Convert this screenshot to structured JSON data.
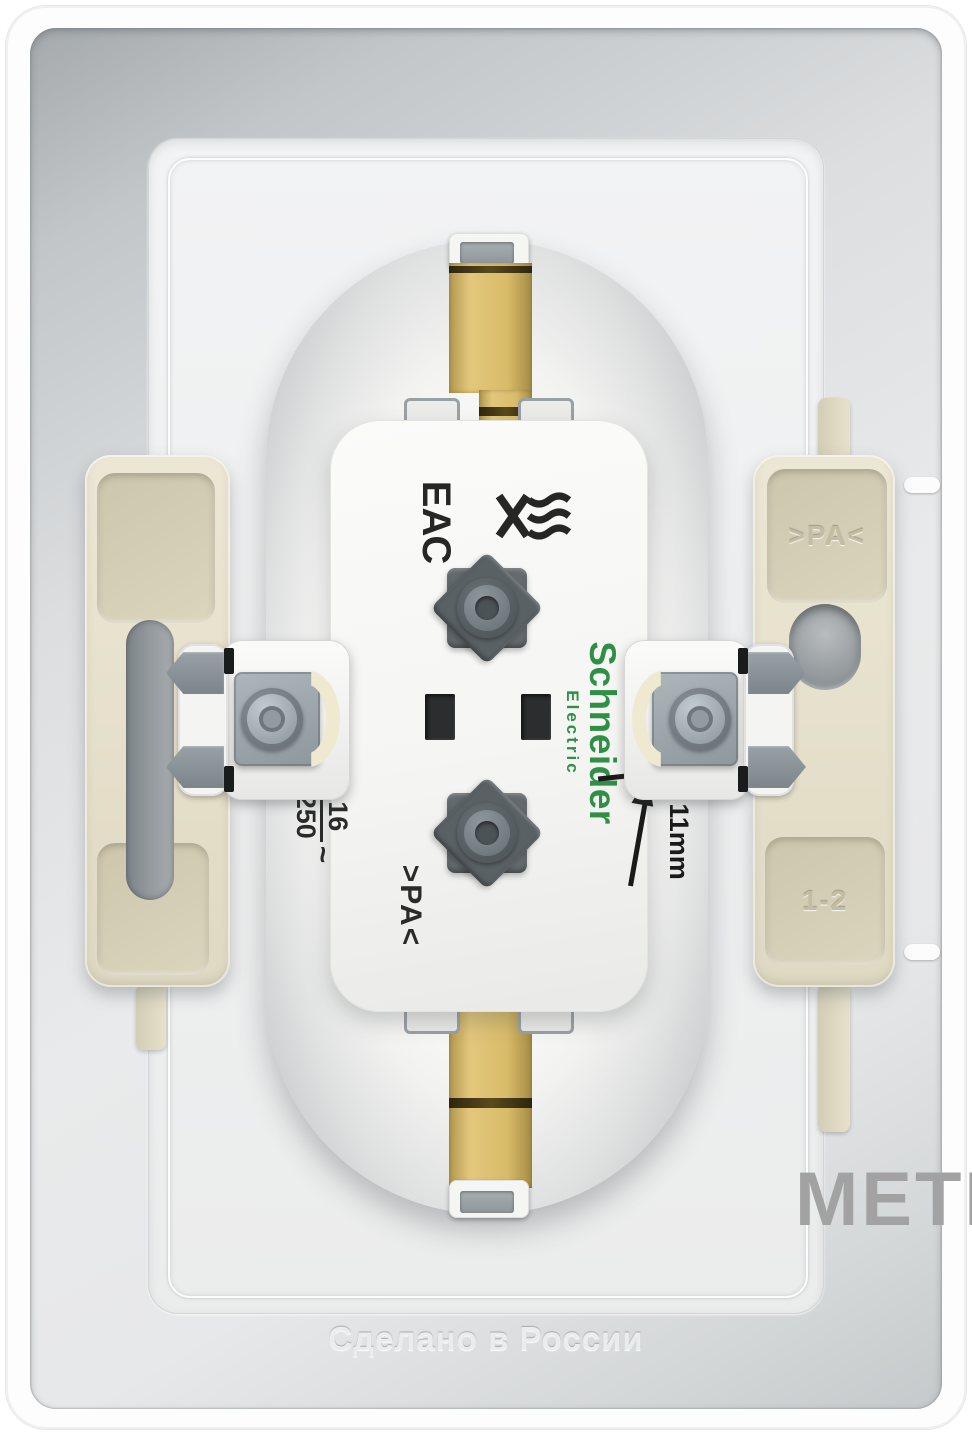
{
  "branding": {
    "name": "Schneider",
    "sub": "Electric"
  },
  "certs": {
    "eac": "ЕАС"
  },
  "ratings": {
    "current": "16",
    "voltage": "250",
    "ac": "~"
  },
  "markings": {
    "pa_body": ">PA<",
    "pa_claw": ">PA<",
    "claw_range": "1-2",
    "dimension": "11mm"
  },
  "bottom": {
    "made_in": "Сделано в России"
  },
  "watermark": {
    "text": "МЕТР"
  },
  "colors": {
    "brass": "#d9bc6a",
    "schneider_green": "#2f8f46",
    "cream_claw": "#e9e4d0",
    "metal_gray": "#9aa3a8",
    "watermark_gray": "#a2a2a2"
  }
}
